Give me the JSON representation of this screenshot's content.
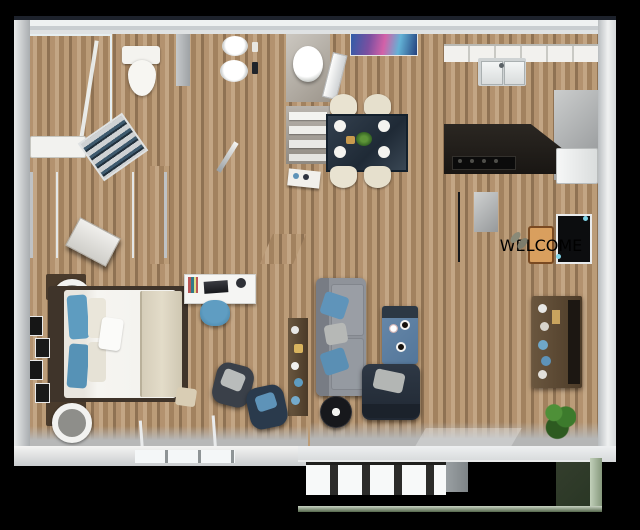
{
  "scene": {
    "kind": "3D rendered apartment floor plan, top-down dollhouse view",
    "background_color": "#000000",
    "visible_text": "WELCOME"
  },
  "entry": {
    "doormat_text": "WELCOME",
    "doormat_color": "#d99f5e",
    "front_door_color": "#0c0d0f",
    "items": [
      "welcome-doormat",
      "shoes",
      "front-door",
      "coat-closet-shelves"
    ]
  },
  "rooms": {
    "bathroom_shower": {
      "label": "bathroom with walk-in shower",
      "items": [
        "teal-tile-shower",
        "toilet",
        "bathtub",
        "towel-shelf"
      ],
      "floor": "wood"
    },
    "bathroom_vanity": {
      "label": "bathroom with double vanity",
      "items": [
        "mosaic-counter",
        "vessel-sink",
        "vessel-sink"
      ],
      "floor": "wood"
    },
    "water_closet": {
      "label": "water closet",
      "items": [
        "toilet"
      ],
      "floor": "gray"
    },
    "linen_closet": {
      "label": "linen closet",
      "items": [
        "white-shelves"
      ],
      "floor": "gray"
    },
    "walk_in_closet": {
      "label": "walk-in closet",
      "items": [
        "clothes-shelves-left",
        "clothes-shelves-right",
        "white-dresser"
      ],
      "floor": "dark-carpet"
    },
    "dining": {
      "label": "dining area",
      "items": [
        "abstract-wall-art",
        "open-door",
        "dining-table",
        "cream-chair",
        "cream-chair",
        "cream-chair",
        "cream-chair",
        "plant-centerpiece"
      ],
      "floor": "wood"
    },
    "kitchen": {
      "label": "kitchen",
      "items": [
        "upper-cabinets",
        "mosaic-counter",
        "double-sink",
        "dark-island-counter",
        "cooktop",
        "refrigerator"
      ],
      "floor": "wood"
    },
    "bedroom": {
      "label": "master bedroom",
      "items": [
        "bed",
        "blue-pillows",
        "nightstand-lamp",
        "nightstand-lamp",
        "wall-frames",
        "desk",
        "desk-chair",
        "bookshelf",
        "armchair",
        "accent-chair",
        "pouf",
        "striped-rug",
        "window"
      ],
      "floor": "speckled-carpet"
    },
    "living": {
      "label": "living room",
      "items": [
        "gray-sofa",
        "blue-throw-pillows",
        "blue-coffee-table",
        "navy-recliner",
        "fan-clock",
        "media-console",
        "tv",
        "potted-plant",
        "vertical-blinds",
        "sliding-glass-door"
      ],
      "floor": "wood"
    },
    "patio": {
      "label": "patio / balcony",
      "items": [
        "concrete-slab",
        "exterior-windows",
        "glass-railing"
      ],
      "floor": "concrete"
    }
  },
  "palette": {
    "background": "#000000",
    "outer_wall": "#c9cdd0",
    "inner_wall": "#ece9e4",
    "wood_light": "#b3926f",
    "wood_dark": "#4e4136",
    "carpet_beige": "#cbb594",
    "carpet_dark": "#474039",
    "shower_teal": "#3f8099",
    "mosaic_tile": "#3e3931",
    "sofa_gray": "#8f939a",
    "accent_blue": "#5e9cc0",
    "table_blue": "#5d80a3",
    "recliner_navy": "#28313d",
    "chair_cream": "#e9e3d1",
    "counter_dark": "#221f1b",
    "plant_green": "#3c7a2c",
    "concrete": "#9da3a4"
  }
}
